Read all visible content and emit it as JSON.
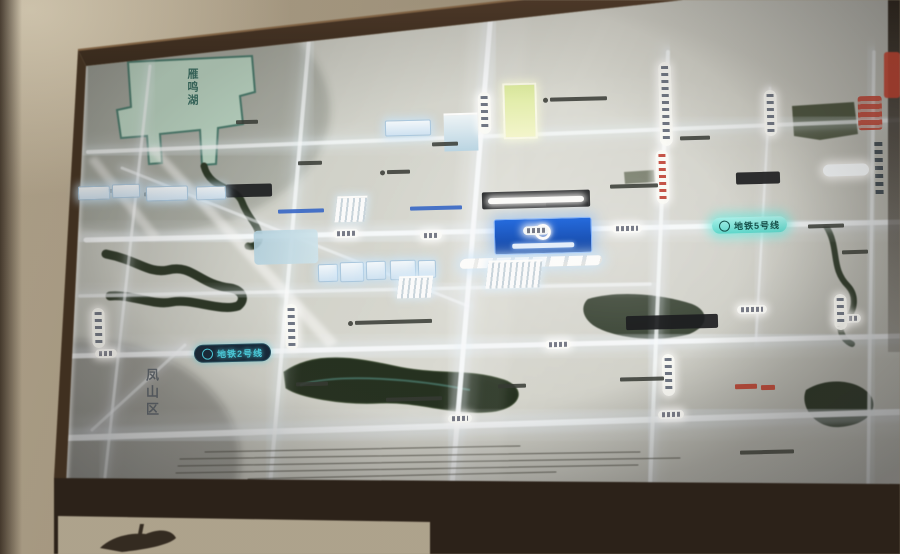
{
  "scene": {
    "kind": "backlit real-estate location map board photographed on a wall",
    "colors": {
      "wall": "#b4a68c",
      "wood_frame": "#4a3322",
      "map_surface": "#cfd0ca",
      "road_glow": "#f8fcff",
      "lake_teal": "#b9d7c6",
      "river_dark": "#202d1c",
      "metro5_teal": "#58d8cd",
      "metro2_cyan": "#45d4e8",
      "project_blue": "#1256c4",
      "accent_red": "#b23526",
      "highlight_yellow": "#e8f0a8"
    }
  },
  "map": {
    "lake_label": "雁鸣湖",
    "district_label": "凤山区",
    "metro_line_5": {
      "label": "地铁5号线",
      "icon": "metro-icon"
    },
    "metro_line_2": {
      "label": "地铁2号线",
      "icon": "metro-icon"
    },
    "project_marker": {
      "icon": "ring-logo-icon"
    }
  },
  "roads": {
    "h": [
      [
        88,
        152,
        900,
        120,
        4,
        0.75
      ],
      [
        86,
        240,
        900,
        222,
        5,
        0.95
      ],
      [
        80,
        296,
        650,
        284,
        3.5,
        0.6
      ],
      [
        72,
        356,
        900,
        336,
        5,
        0.9
      ],
      [
        66,
        438,
        900,
        412,
        6,
        0.95
      ]
    ],
    "v": [
      [
        150,
        66,
        104,
        486,
        3,
        0.6
      ],
      [
        310,
        28,
        270,
        486,
        4,
        0.75
      ],
      [
        492,
        0,
        452,
        486,
        5,
        0.95
      ],
      [
        668,
        52,
        650,
        486,
        4,
        0.8
      ],
      [
        770,
        88,
        756,
        340,
        2.5,
        0.5
      ],
      [
        874,
        52,
        868,
        486,
        3.5,
        0.7
      ]
    ],
    "d": [
      [
        122,
        168,
        468,
        306,
        3,
        0.55
      ],
      [
        92,
        430,
        185,
        345,
        3,
        0.5
      ]
    ]
  },
  "features": {
    "stations": [
      {
        "x": 333,
        "y": 229,
        "w": 26
      },
      {
        "x": 420,
        "y": 231,
        "w": 22
      },
      {
        "x": 523,
        "y": 226,
        "w": 26
      },
      {
        "x": 612,
        "y": 224,
        "w": 30
      },
      {
        "x": 95,
        "y": 349,
        "w": 22
      },
      {
        "x": 545,
        "y": 340,
        "w": 26
      },
      {
        "x": 737,
        "y": 305,
        "w": 30
      },
      {
        "x": 835,
        "y": 314,
        "w": 26
      },
      {
        "x": 448,
        "y": 414,
        "w": 24
      },
      {
        "x": 658,
        "y": 410,
        "w": 26
      }
    ],
    "capsules": [
      {
        "x": 478,
        "y": 92,
        "h": 42
      },
      {
        "x": 659,
        "y": 62,
        "h": 84
      },
      {
        "x": 764,
        "y": 90,
        "h": 46
      },
      {
        "x": 656,
        "y": 150,
        "h": 54,
        "v": "red"
      },
      {
        "x": 285,
        "y": 304,
        "h": 46
      },
      {
        "x": 92,
        "y": 308,
        "h": 40
      },
      {
        "x": 662,
        "y": 354,
        "h": 42
      },
      {
        "x": 834,
        "y": 294,
        "h": 36
      },
      {
        "x": 872,
        "y": 138,
        "h": 62,
        "v": "dark"
      }
    ],
    "marks": [
      {
        "x": 96,
        "y": 189,
        "w": 26
      },
      {
        "x": 144,
        "y": 192,
        "w": 34
      },
      {
        "x": 298,
        "y": 161,
        "w": 24
      },
      {
        "x": 380,
        "y": 170,
        "w": 30,
        "dot": 1
      },
      {
        "x": 543,
        "y": 97,
        "w": 64,
        "dot": 1
      },
      {
        "x": 610,
        "y": 184,
        "w": 48
      },
      {
        "x": 546,
        "y": 202,
        "w": 42
      },
      {
        "x": 680,
        "y": 136,
        "w": 30
      },
      {
        "x": 808,
        "y": 224,
        "w": 36
      },
      {
        "x": 842,
        "y": 250,
        "w": 26
      },
      {
        "x": 348,
        "y": 320,
        "w": 84,
        "dot": 1
      },
      {
        "x": 296,
        "y": 382,
        "w": 32
      },
      {
        "x": 386,
        "y": 397,
        "w": 56
      },
      {
        "x": 498,
        "y": 384,
        "w": 28
      },
      {
        "x": 620,
        "y": 377,
        "w": 44
      },
      {
        "x": 740,
        "y": 450,
        "w": 54
      },
      {
        "x": 432,
        "y": 142,
        "w": 26
      },
      {
        "x": 236,
        "y": 120,
        "w": 22
      }
    ],
    "boxes": [
      {
        "x": 226,
        "y": 184,
        "w": 46,
        "h": 13
      },
      {
        "x": 482,
        "y": 191,
        "w": 108,
        "h": 17,
        "glow": 1
      },
      {
        "x": 626,
        "y": 315,
        "w": 92,
        "h": 14
      },
      {
        "x": 736,
        "y": 172,
        "w": 44,
        "h": 12
      }
    ],
    "blue_marks": [
      {
        "x": 278,
        "y": 209,
        "w": 46
      },
      {
        "x": 410,
        "y": 206,
        "w": 52
      }
    ],
    "red_marks": [
      {
        "x": 735,
        "y": 384,
        "w": 22
      },
      {
        "x": 761,
        "y": 385,
        "w": 14
      }
    ],
    "glow_labels": [
      {
        "x": 823,
        "y": 164,
        "w": 46,
        "h": 12
      }
    ],
    "bglow": [
      {
        "x": 78,
        "y": 186,
        "w": 30,
        "h": 12
      },
      {
        "x": 112,
        "y": 184,
        "w": 26,
        "h": 12
      },
      {
        "x": 146,
        "y": 186,
        "w": 40,
        "h": 13
      },
      {
        "x": 196,
        "y": 186,
        "w": 28,
        "h": 12
      },
      {
        "x": 385,
        "y": 120,
        "w": 44,
        "h": 14
      },
      {
        "x": 318,
        "y": 264,
        "w": 18,
        "h": 16
      },
      {
        "x": 340,
        "y": 262,
        "w": 22,
        "h": 18
      },
      {
        "x": 366,
        "y": 261,
        "w": 18,
        "h": 17
      },
      {
        "x": 390,
        "y": 260,
        "w": 24,
        "h": 18
      },
      {
        "x": 418,
        "y": 260,
        "w": 16,
        "h": 16
      }
    ],
    "clusters": [
      {
        "x": 487,
        "y": 260,
        "w": 54,
        "h": 26
      },
      {
        "x": 336,
        "y": 196,
        "w": 30,
        "h": 24
      },
      {
        "x": 398,
        "y": 276,
        "w": 34,
        "h": 20
      }
    ],
    "scale_lines": [
      [
        205,
        452,
        520,
        446
      ],
      [
        180,
        459,
        640,
        452
      ],
      [
        178,
        466,
        680,
        458
      ],
      [
        176,
        473,
        638,
        465
      ],
      [
        248,
        479,
        556,
        472
      ]
    ]
  }
}
